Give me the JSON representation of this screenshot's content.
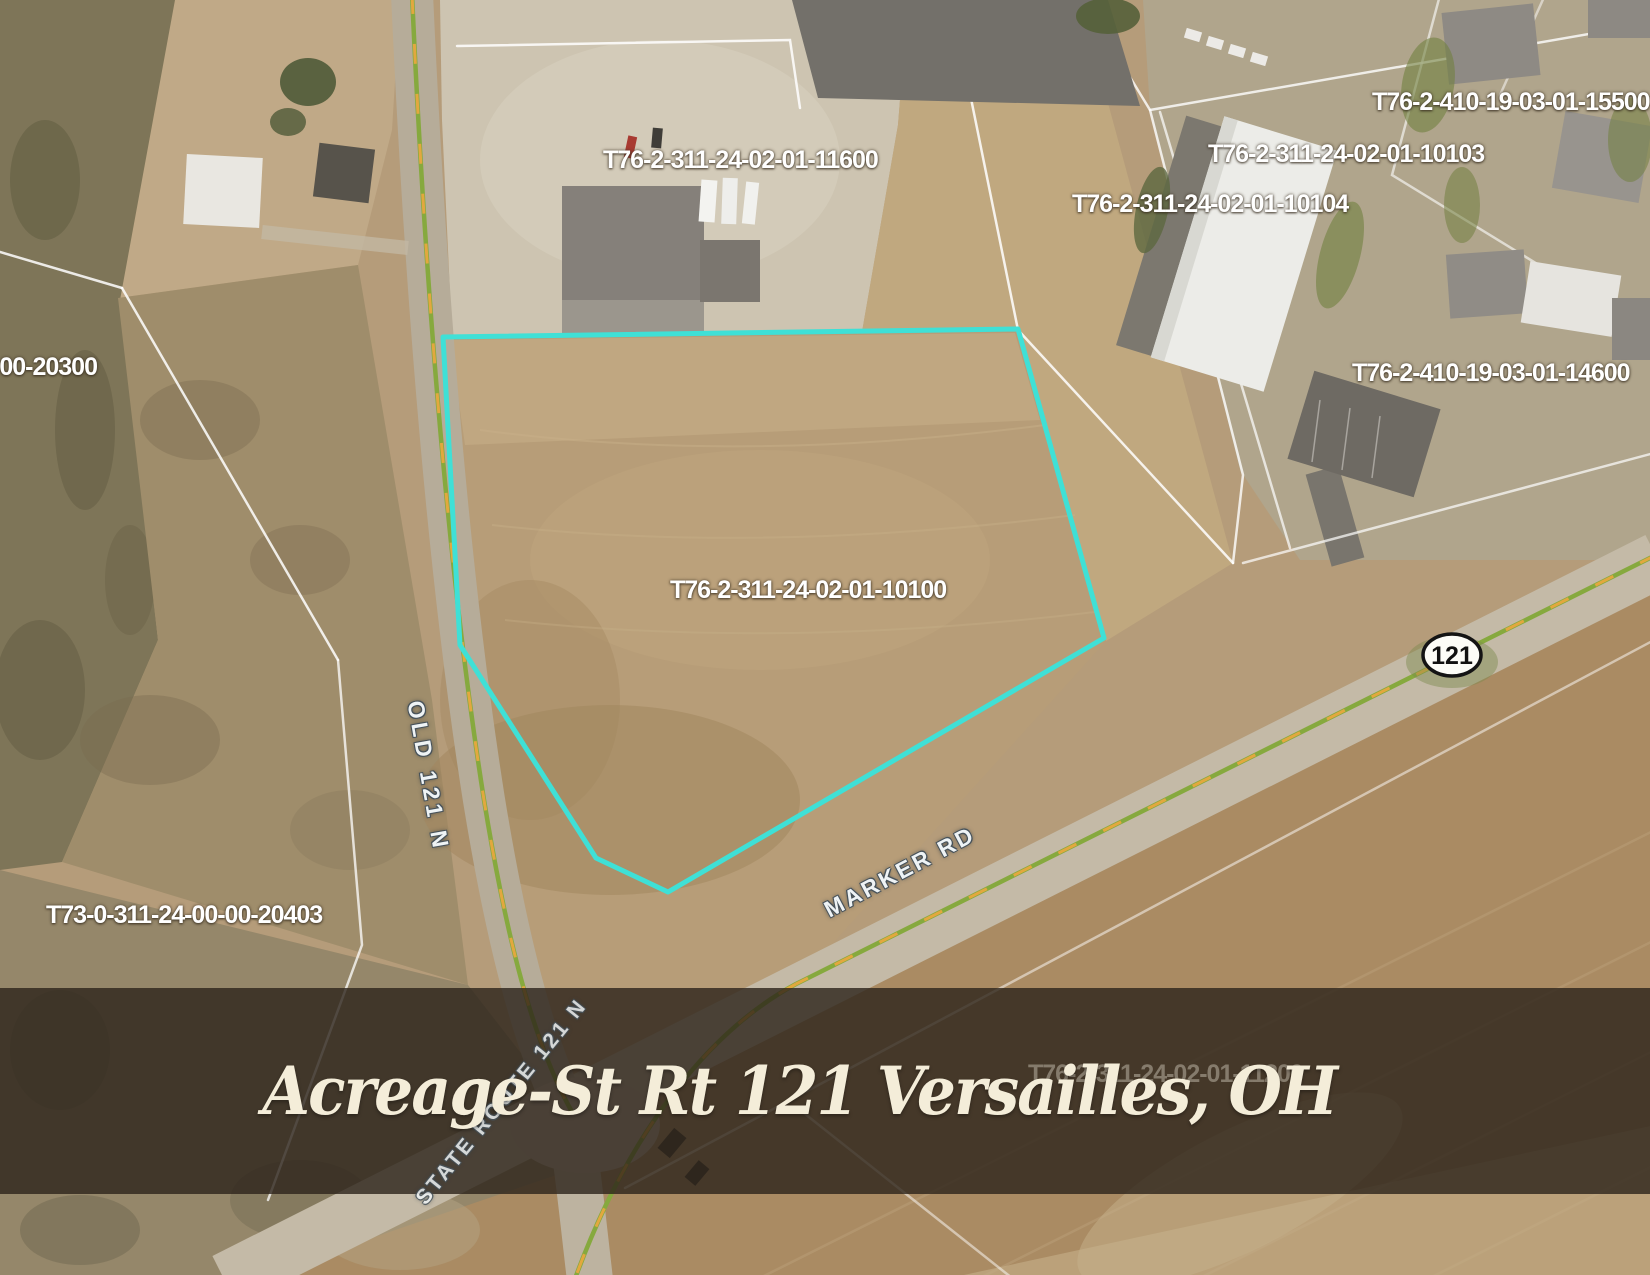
{
  "banner": {
    "title": "Acreage-St Rt 121 Versailles, OH",
    "bg_color": "#2c231a",
    "text_color": "#f4edd9"
  },
  "highlight": {
    "outline_color": "#3FE0D6",
    "highlighted_parcel_id": "T76-2-311-24-02-01-10100"
  },
  "parcel_labels": [
    {
      "id": "T76-2-311-24-02-01-11600"
    },
    {
      "id": "T76-2-410-19-03-01-15500"
    },
    {
      "id": "T76-2-311-24-02-01-10103"
    },
    {
      "id": "T76-2-311-24-02-01-10104"
    },
    {
      "id": "T76-2-410-19-03-01-14600"
    },
    {
      "id": "T76-2-311-24-02-01-10100"
    },
    {
      "id": "-00-20300"
    },
    {
      "id": "T73-0-311-24-00-00-20403"
    },
    {
      "id": "T76-2-311-24-02-01-11200"
    }
  ],
  "road_labels": [
    {
      "name": "OLD 121 N"
    },
    {
      "name": "MARKER RD"
    },
    {
      "name": "STATE ROUTE 121 N"
    }
  ],
  "route_shield": {
    "number": "121"
  }
}
